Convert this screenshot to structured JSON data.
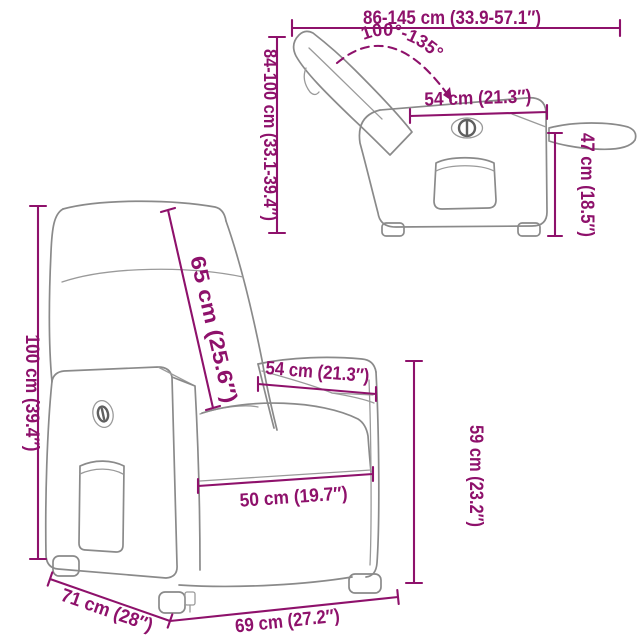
{
  "page": {
    "background": "#ffffff",
    "description": "Product dimension diagram of a power recliner chair, shown reclined (top right) and upright (bottom left)"
  },
  "colors": {
    "dimension_accent": "#8e116b",
    "line_art": "#8a8a8a"
  },
  "views": {
    "reclined": {
      "name": "reclined side view",
      "labels": {
        "total_length": "86-145 cm (33.9-57.1″)",
        "recline_angle": "100°-135°",
        "height_range": "84-100 cm (33.1-39.4″)",
        "seat_depth": "54 cm (21.3″)",
        "footrest_height": "47 cm (18.5″)"
      }
    },
    "upright": {
      "name": "upright three-quarter view",
      "labels": {
        "total_height": "100 cm (39.4″)",
        "backrest_length": "65 cm (25.6″)",
        "seat_width_top": "54 cm (21.3″)",
        "armrest_height": "59 cm (23.2″)",
        "seat_width_front": "50 cm (19.7″)",
        "depth": "71 cm (28″)",
        "width": "69 cm (27.2″)"
      }
    }
  }
}
